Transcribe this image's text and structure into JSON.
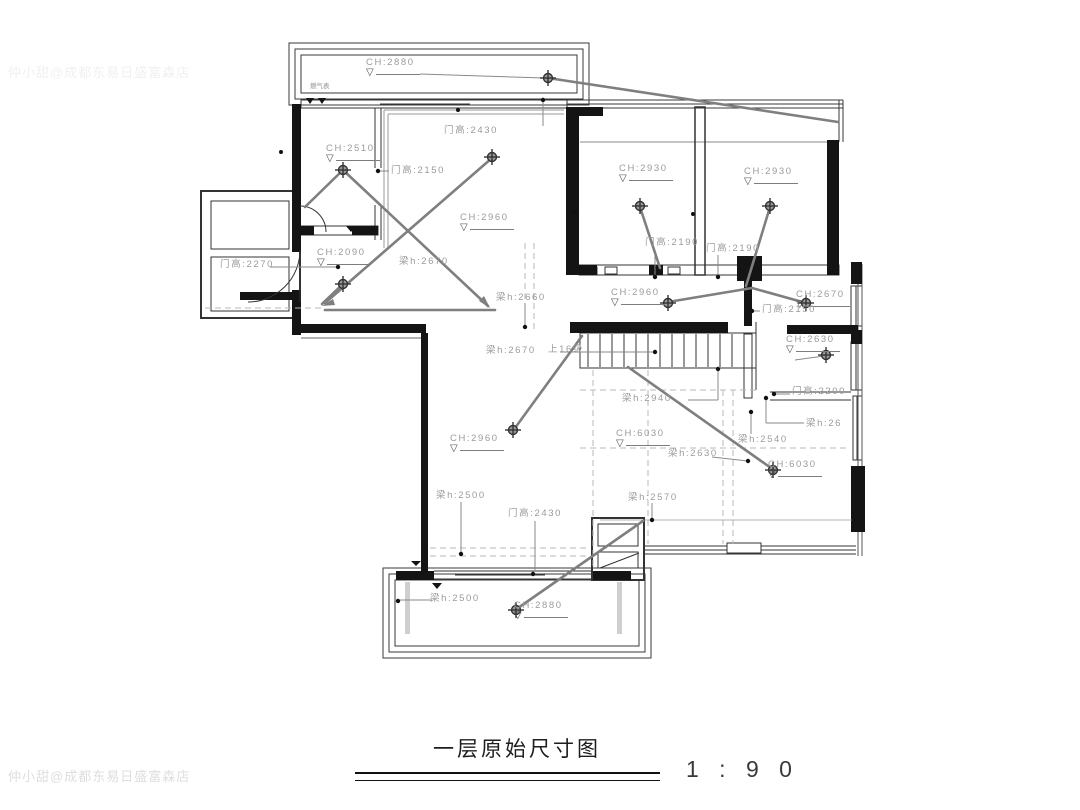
{
  "icons": {
    "flag": "▽"
  },
  "watermark": {
    "text": "仲小甜@成都东易日盛富森店"
  },
  "title": {
    "text": "一层原始尺寸图"
  },
  "scale": {
    "ratio_text": "1 : 9 0"
  },
  "plan": {
    "labels": [
      {
        "text": "CH:2880",
        "kind": "ceiling-height"
      },
      {
        "text": "门高:2430",
        "kind": "door-height"
      },
      {
        "text": "CH:2510",
        "kind": "ceiling-height"
      },
      {
        "text": "门高:2150",
        "kind": "door-height"
      },
      {
        "text": "CH:2960",
        "kind": "ceiling-height"
      },
      {
        "text": "CH:2930",
        "kind": "ceiling-height"
      },
      {
        "text": "CH:2930",
        "kind": "ceiling-height"
      },
      {
        "text": "门高:2190",
        "kind": "door-height"
      },
      {
        "text": "门高:2190",
        "kind": "door-height"
      },
      {
        "text": "CH:2090",
        "kind": "ceiling-height"
      },
      {
        "text": "门高:2270",
        "kind": "door-height"
      },
      {
        "text": "梁h:2670",
        "kind": "beam-height"
      },
      {
        "text": "CH:2670",
        "kind": "ceiling-height"
      },
      {
        "text": "门高:2150",
        "kind": "door-height"
      },
      {
        "text": "梁h:2660",
        "kind": "beam-height"
      },
      {
        "text": "CH:2960",
        "kind": "ceiling-height"
      },
      {
        "text": "CH:2630",
        "kind": "ceiling-height"
      },
      {
        "text": "梁h:2670",
        "kind": "beam-height"
      },
      {
        "text": "上16级",
        "kind": "stair-note"
      },
      {
        "text": "梁h:2940",
        "kind": "beam-height"
      },
      {
        "text": "门高:2200",
        "kind": "door-height"
      },
      {
        "text": "梁h:26",
        "kind": "beam-height"
      },
      {
        "text": "CH:6030",
        "kind": "ceiling-height"
      },
      {
        "text": "梁h:2540",
        "kind": "beam-height"
      },
      {
        "text": "梁h:2630",
        "kind": "beam-height"
      },
      {
        "text": "CH:6030",
        "kind": "ceiling-height"
      },
      {
        "text": "CH:2960",
        "kind": "ceiling-height"
      },
      {
        "text": "梁h:2500",
        "kind": "beam-height"
      },
      {
        "text": "梁h:2570",
        "kind": "beam-height"
      },
      {
        "text": "门高:2430",
        "kind": "door-height"
      },
      {
        "text": "梁h:2500",
        "kind": "beam-height"
      },
      {
        "text": "CH:2880",
        "kind": "ceiling-height"
      },
      {
        "text": "燃气表",
        "kind": "fixture-note"
      }
    ]
  }
}
